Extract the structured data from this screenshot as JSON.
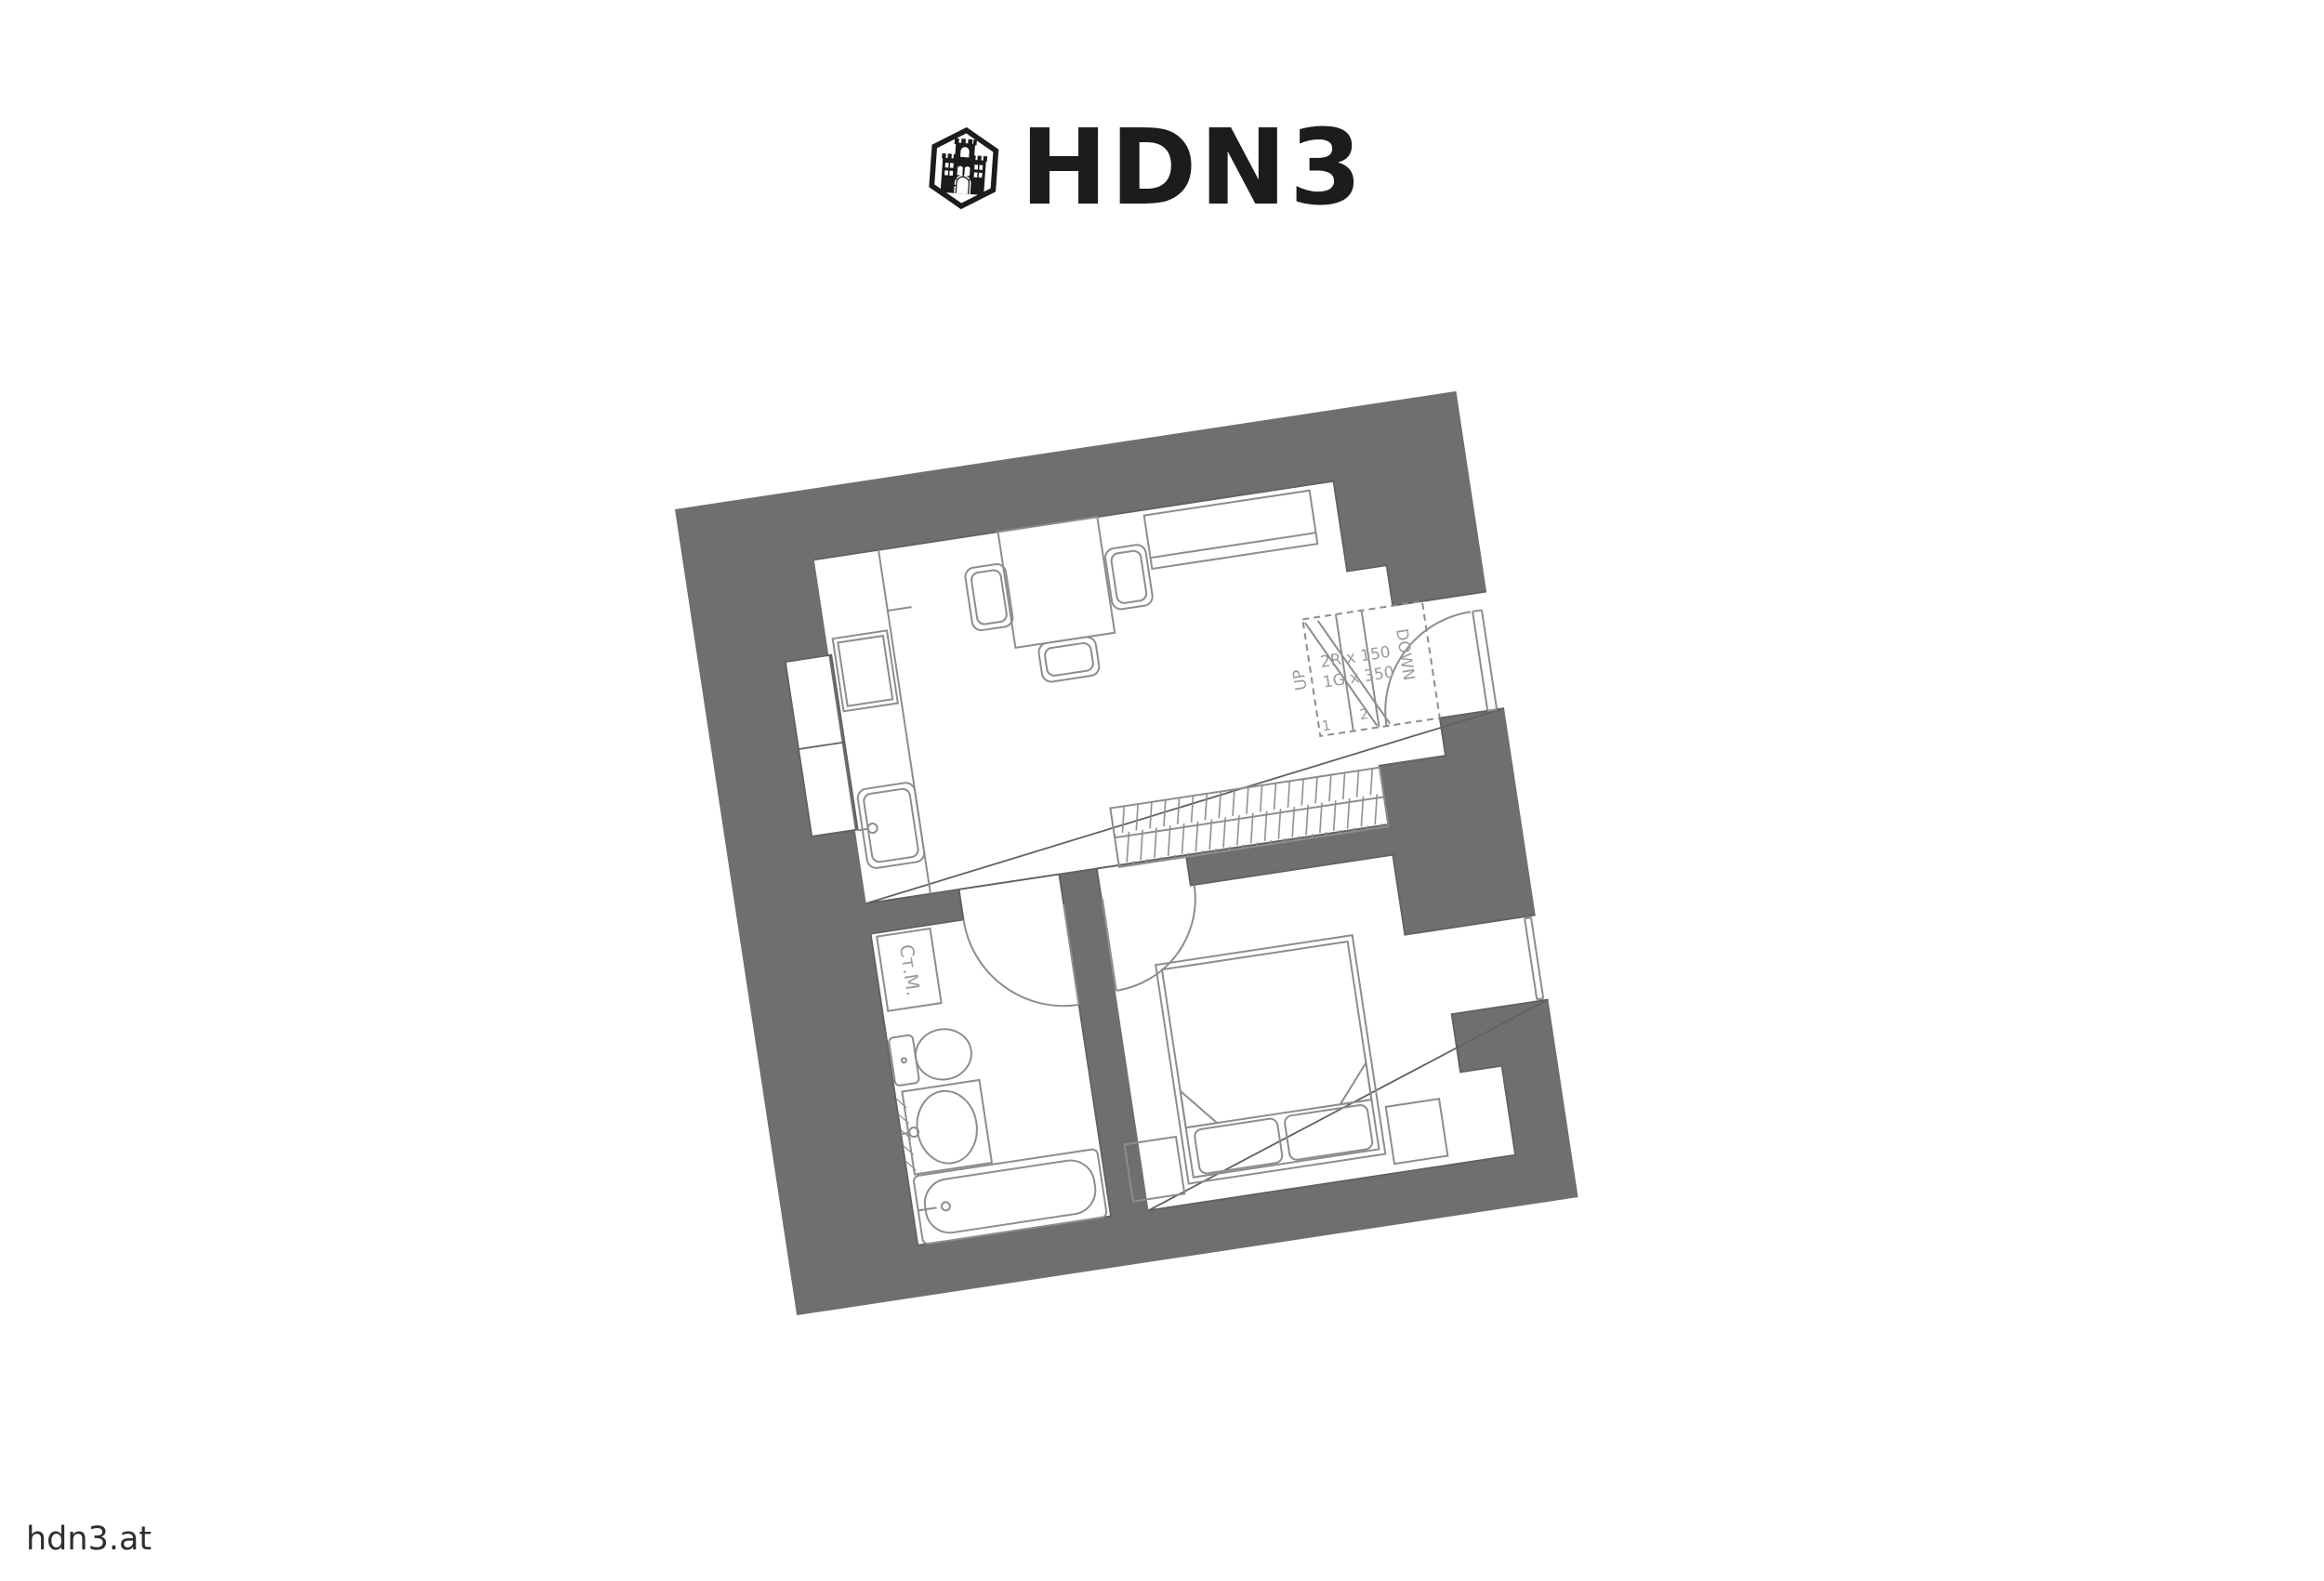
{
  "logo": {
    "icon": "castle-hexagon-icon",
    "text": "HDN3"
  },
  "watermark": {
    "text": "hdn3.at"
  },
  "floorplan": {
    "colors": {
      "wall": "#6F6F71",
      "outline": "#616163",
      "furniture": "#8D8D8F",
      "label": "#9A9A9C"
    },
    "stairs": {
      "riser_note": "2R x 150",
      "going_note": "1G x 350",
      "up_label": "UP",
      "down_label": "DOWN",
      "step_numbers": [
        "1",
        "2"
      ]
    },
    "bathroom": {
      "washing_machine_label": "Ст.М."
    }
  }
}
